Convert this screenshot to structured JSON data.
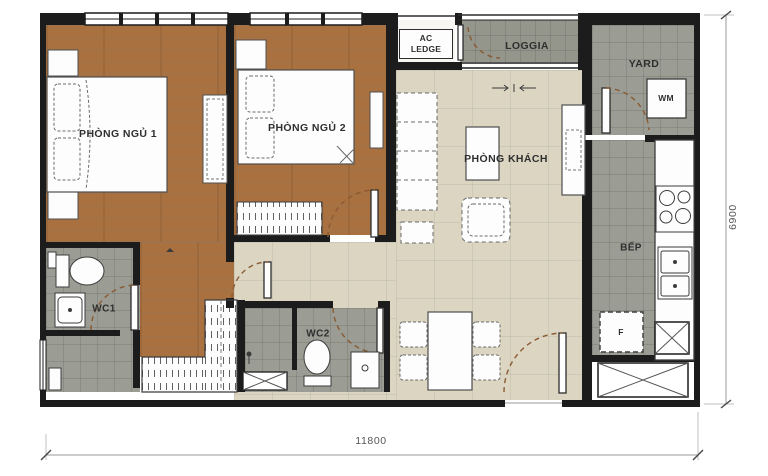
{
  "plan": {
    "rooms": {
      "bedroom1": {
        "label": "PHÒNG NGỦ 1"
      },
      "bedroom2": {
        "label": "PHÒNG NGỦ 2"
      },
      "living": {
        "label": "PHÒNG KHÁCH"
      },
      "kitchen": {
        "label": "BẾP"
      },
      "wc1": {
        "label": "WC1"
      },
      "wc2": {
        "label": "WC2"
      },
      "loggia": {
        "label": "LOGGIA"
      },
      "yard": {
        "label": "YARD"
      },
      "ac_ledge": {
        "line1": "AC",
        "line2": "LEDGE"
      }
    },
    "appliances": {
      "washing_machine": "WM",
      "fridge": "F"
    },
    "dimensions": {
      "overall_width_mm": "11800",
      "overall_height_mm": "6900"
    },
    "colors": {
      "wood_floor": "#a9713f",
      "tile_beige": "#dbd5c1",
      "tile_grey": "#9b9c93",
      "wall": "#1c1c1c",
      "door_arc": "#8a5a33"
    }
  }
}
